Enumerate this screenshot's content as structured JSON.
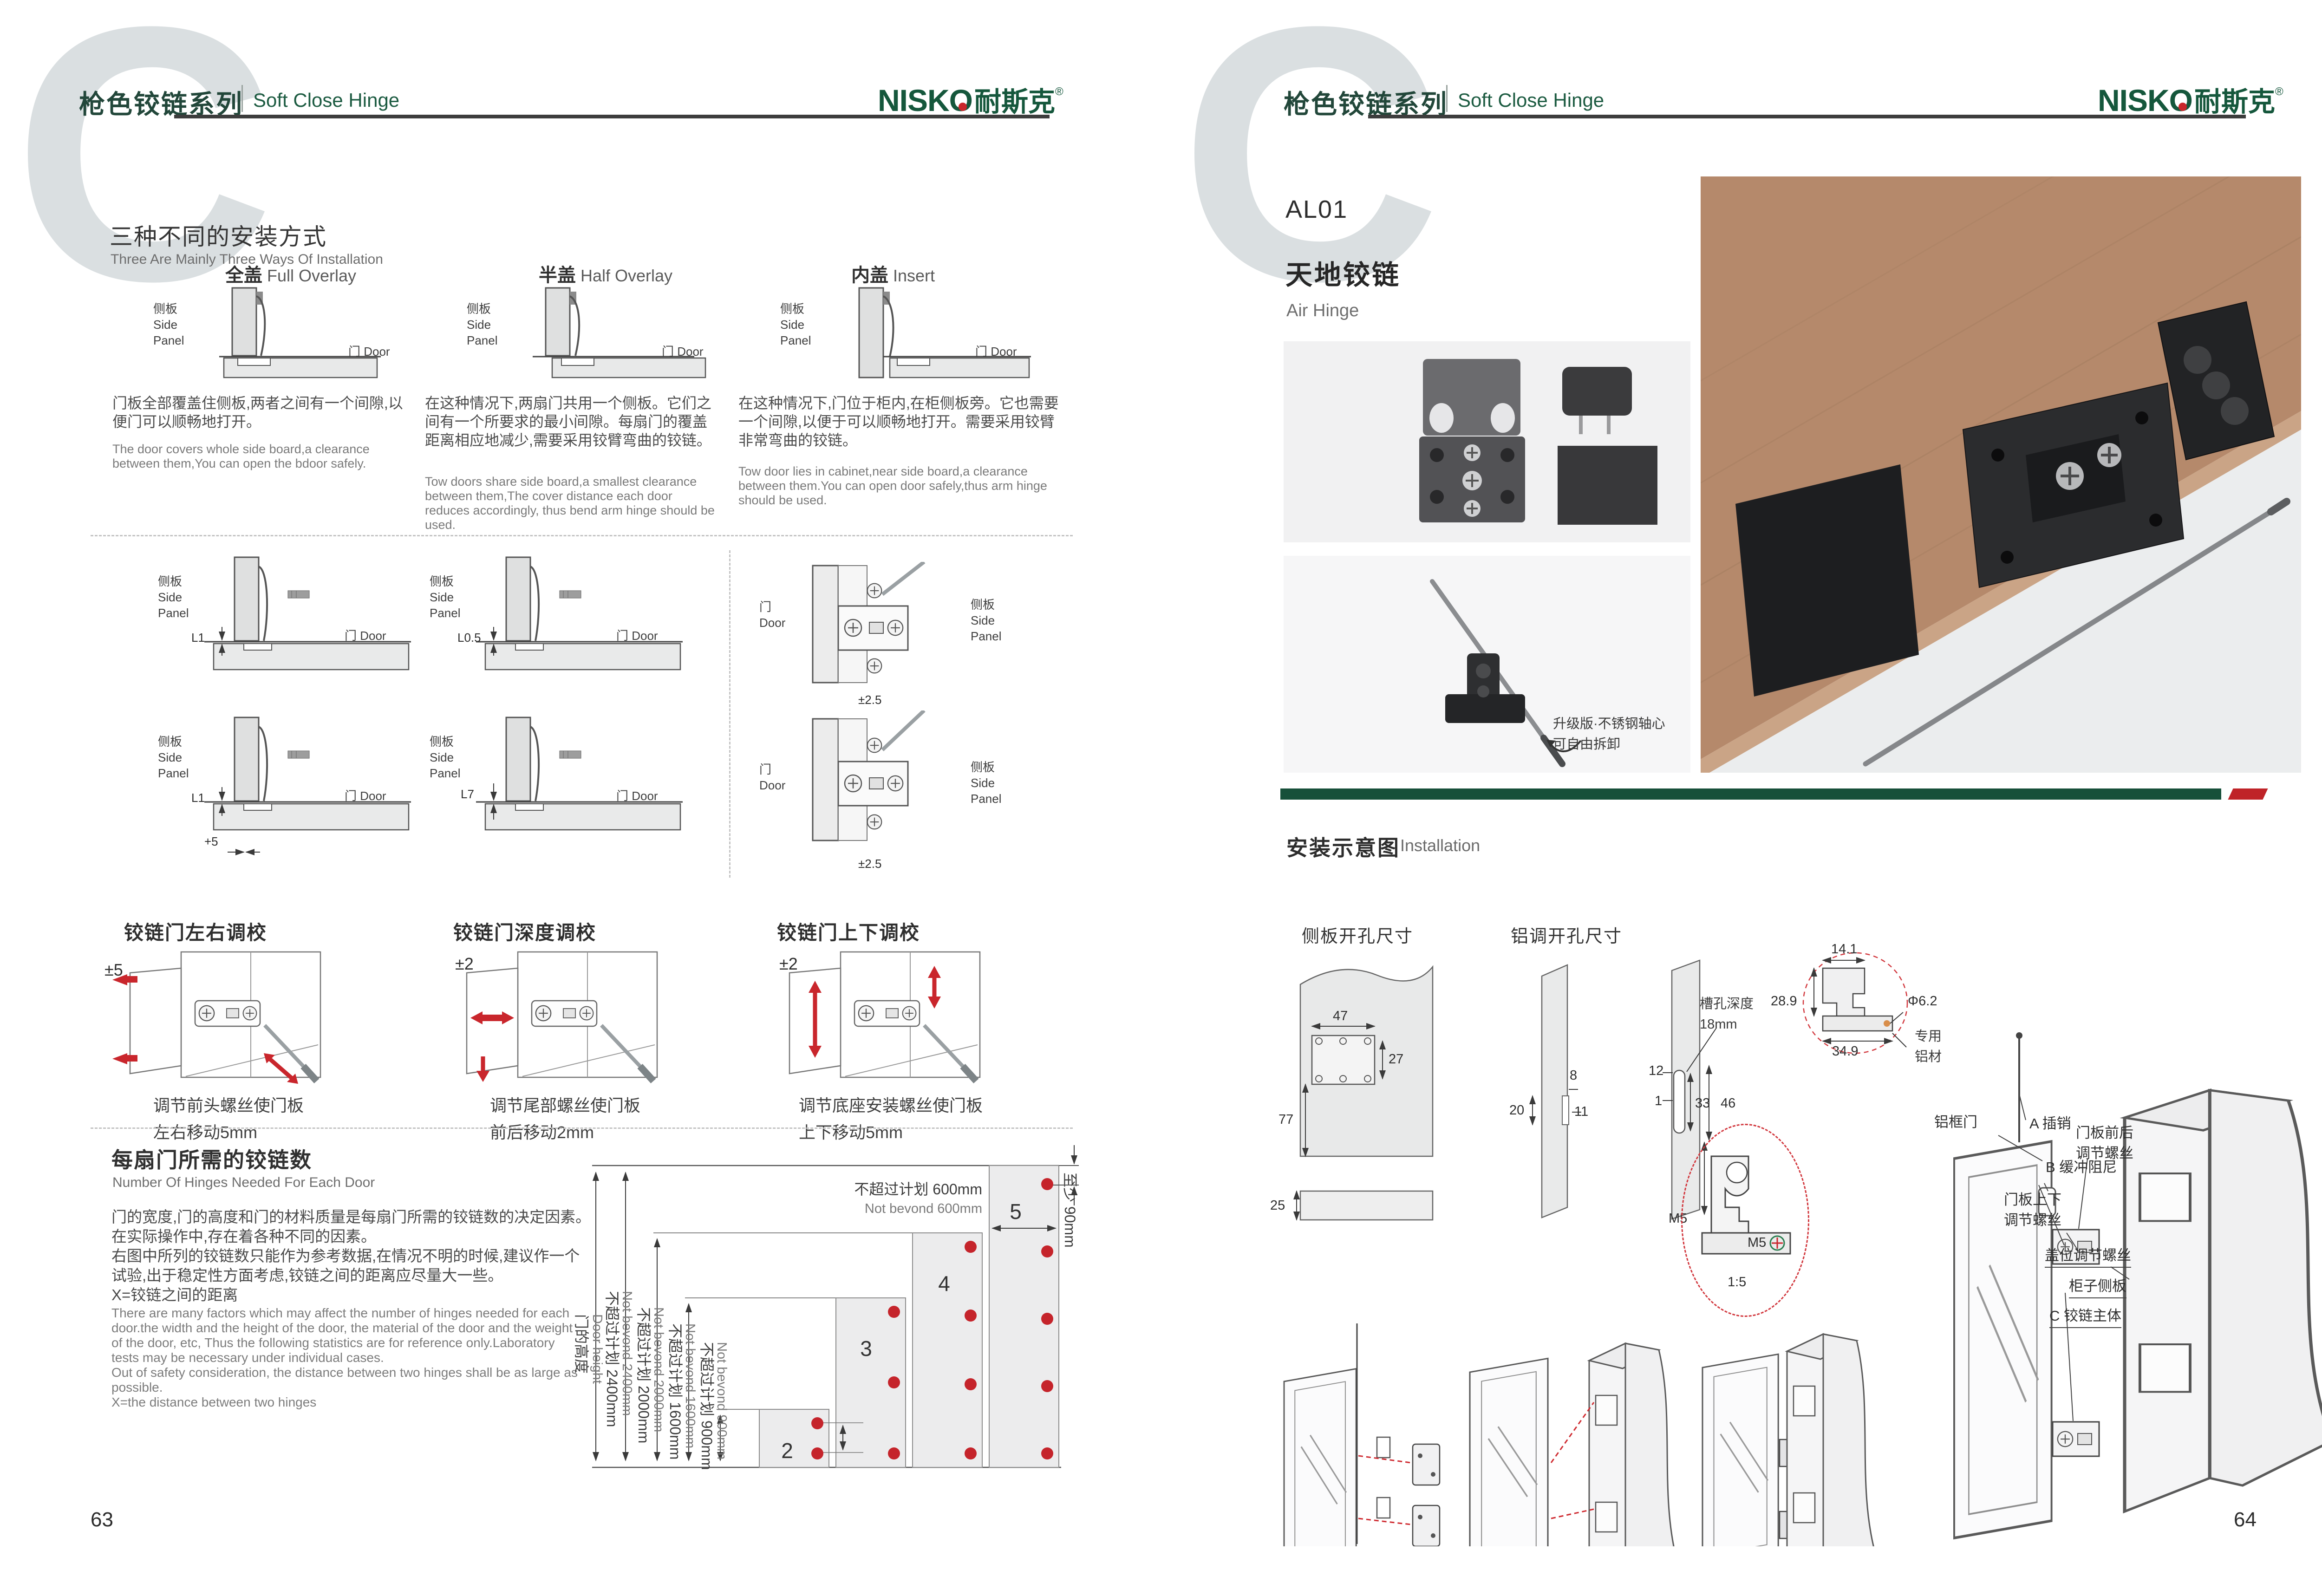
{
  "brand": {
    "logo_latin": "NISKO",
    "logo_cn": "耐斯克",
    "reg": "®"
  },
  "left": {
    "watermark": "C",
    "page_no": "63",
    "header": {
      "series_zh": "枪色铰链系列",
      "series_en": "Soft Close Hinge"
    },
    "ways": {
      "title_zh": "三种不同的安装方式",
      "title_en": "Three Are Mainly Three Ways Of Installation",
      "side_zh": "侧板",
      "side_en1": "Side",
      "side_en2": "Panel",
      "door": "门 Door",
      "door_zh": "门",
      "door_en": "Door",
      "items": [
        {
          "name_zh": "全盖",
          "name_en": "Full Overlay",
          "desc_zh": "门板全部覆盖住侧板,两者之间有一个间隙,以便门可以顺畅地打开。",
          "desc_en": "The door covers whole side board,a clearance between them,You can open the bdoor safely."
        },
        {
          "name_zh": "半盖",
          "name_en": "Half Overlay",
          "desc_zh": "在这种情况下,两扇门共用一个侧板。它们之间有一个所要求的最小间隙。每扇门的覆盖距离相应地减少,需要采用铰臂弯曲的铰链。",
          "desc_en": "Tow doors share side board,a smallest clearance between them,The cover distance each door reduces accordingly, thus bend arm hinge should be used."
        },
        {
          "name_zh": "内盖",
          "name_en": "Insert",
          "desc_zh": "在这种情况下,门位于柜内,在柜侧板旁。它也需要一个间隙,以便于可以顺畅地打开。需要采用铰臂非常弯曲的铰链。",
          "desc_en": "Tow door lies in cabinet,near side board,a clearance between them.You can open door safely,thus arm hinge should be used."
        }
      ]
    },
    "dims": {
      "cells": [
        {
          "v": "L1"
        },
        {
          "v": "L0.5"
        },
        {
          "v": "L1",
          "v2": "+5"
        },
        {
          "v": "L7"
        }
      ],
      "front_top": "±2.5",
      "front_bottom": "±2.5"
    },
    "adjust": {
      "items": [
        {
          "title": "铰链门左右调校",
          "range": "±5",
          "cap1": "调节前头螺丝使门板",
          "cap2": "左右移动5mm"
        },
        {
          "title": "铰链门深度调校",
          "range": "±2",
          "cap1": "调节尾部螺丝使门板",
          "cap2": "前后移动2mm"
        },
        {
          "title": "铰链门上下调校",
          "range": "±2",
          "cap1": "调节底座安装螺丝使门板",
          "cap2": "上下移动5mm"
        }
      ]
    },
    "count": {
      "title_zh": "每扇门所需的铰链数",
      "title_en": "Number Of Hinges Needed For Each Door",
      "zh_lines": [
        "门的宽度,门的高度和门的材料质量是每扇门所需的铰链数的决定因素。",
        "在实际操作中,存在着各种不同的因素。",
        "右图中所列的铰链数只能作为参考数据,在情况不明的时候,建议作一个",
        "试验,出于稳定性方面考虑,铰链之间的距离应尽量大一些。",
        "X=铰链之间的距离"
      ],
      "en_lines": [
        "There are many factors which may affect the number of hinges needed for each",
        "door.the width and the height of the door, the material of the door and the weight",
        "of the door, etc, Thus the following statistics are for reference only.Laboratory",
        "tests may be necessary under individual cases.",
        "Out of safety consideration, the distance between two hinges shall be as large as",
        "possible.",
        "X=the distance between two hinges"
      ],
      "chart": {
        "type": "bar",
        "ylabel_zh": "门的高度",
        "ylabel_en": "Door height",
        "levels": [
          {
            "zh": "不超过计划 2400mm",
            "en": "Not bevond 2400mm",
            "mm": 2400
          },
          {
            "zh": "不超过计划 2000mm",
            "en": "Not bevond 2000mm",
            "mm": 2000
          },
          {
            "zh": "不超过计划 1600mm",
            "en": "Not bevond 1600mm",
            "mm": 1600
          },
          {
            "zh": "不超过计划 900mm",
            "en": "Not bevond 900mm",
            "mm": 900
          }
        ],
        "width_zh": "不超过计划 600mm",
        "width_en": "Not bevond 600mm",
        "edge_zh": "至少 90mm",
        "edge_en": "Not less than 90mm",
        "bars": [
          {
            "hinges": "2",
            "max_height_mm": 900
          },
          {
            "hinges": "3",
            "max_height_mm": 1600
          },
          {
            "hinges": "4",
            "max_height_mm": 2000
          },
          {
            "hinges": "5",
            "max_height_mm": 2400
          }
        ]
      }
    }
  },
  "right": {
    "watermark": "C",
    "page_no": "64",
    "header": {
      "series_zh": "枪色铰链系列",
      "series_en": "Soft Close Hinge"
    },
    "product": {
      "code": "AL01",
      "name_zh": "天地铰链",
      "name_en": "Air Hinge"
    },
    "photo_note": {
      "line1": "升级版·不锈钢轴心",
      "line2": "可自由拆卸"
    },
    "install_title": {
      "zh": "安装示意图",
      "en": "Installation"
    },
    "drill_side": {
      "title": "侧板开孔尺寸",
      "d47": "47",
      "d27": "27",
      "d77": "77",
      "d25": "25"
    },
    "drill_alu": {
      "title": "铝调开孔尺寸",
      "slot1": "槽孔深度",
      "slot2": "18mm",
      "d8": "8",
      "d20": "20",
      "d11": "11",
      "d12": "12",
      "d1": "1",
      "d33": "33",
      "d46": "46",
      "d155": "15.5",
      "m5": "M5"
    },
    "profile": {
      "d141": "14.1",
      "d289": "28.9",
      "dia": "Φ6.2",
      "d349": "34.9",
      "mat1": "专用",
      "mat2": "铝材",
      "scale": "1:5",
      "m5": "M5"
    },
    "exploded": {
      "frame": "铝框门",
      "pin": "A 插销",
      "damper": "B 缓冲阻尼",
      "fb1": "门板前后",
      "fb2": "调节螺丝",
      "ud1": "门板上下",
      "ud2": "调节螺丝",
      "cover": "盖位调节螺丝",
      "side": "柜子侧板",
      "body": "C 铰链主体"
    }
  }
}
